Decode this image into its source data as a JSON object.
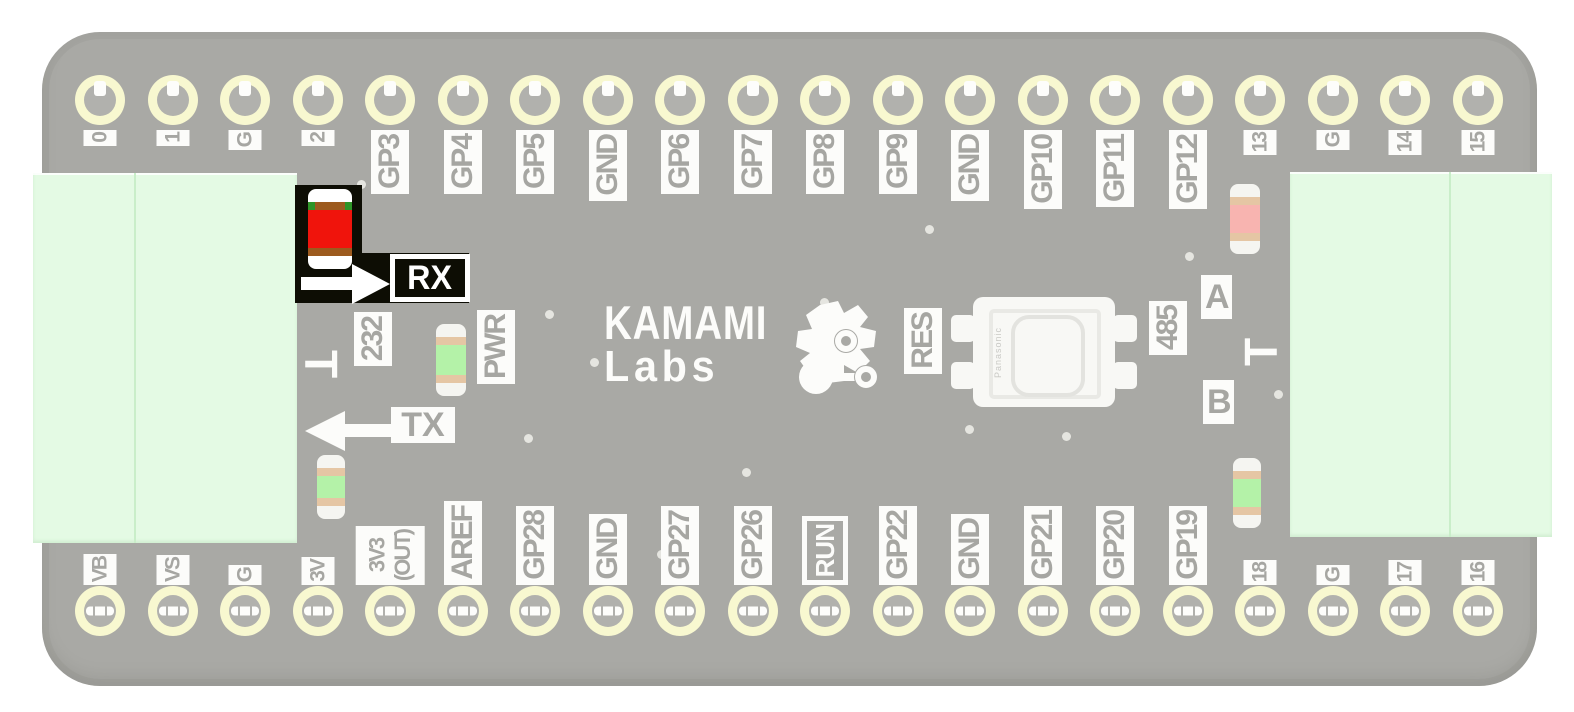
{
  "board": {
    "logo": {
      "line1": "KAMAMI",
      "line2": "Labs"
    },
    "highlight": {
      "label": "RX"
    },
    "silkscreen": {
      "tx": "TX",
      "rs232": "232",
      "rs485": "485",
      "pwr": "PWR",
      "res": "RES",
      "a": "A",
      "b": "B",
      "t_left": "T",
      "t_right": "T"
    },
    "button": {
      "brand": "Panasonic"
    },
    "top_pins": [
      {
        "label": "0",
        "type": "sm"
      },
      {
        "label": "1",
        "type": "sm"
      },
      {
        "label": "G",
        "type": "sm"
      },
      {
        "label": "2",
        "type": "sm"
      },
      {
        "label": "GP3",
        "type": "gp"
      },
      {
        "label": "GP4",
        "type": "gp"
      },
      {
        "label": "GP5",
        "type": "gp"
      },
      {
        "label": "GND",
        "type": "gp"
      },
      {
        "label": "GP6",
        "type": "gp"
      },
      {
        "label": "GP7",
        "type": "gp"
      },
      {
        "label": "GP8",
        "type": "gp"
      },
      {
        "label": "GP9",
        "type": "gp"
      },
      {
        "label": "GND",
        "type": "gp"
      },
      {
        "label": "GP10",
        "type": "gp"
      },
      {
        "label": "GP11",
        "type": "gp"
      },
      {
        "label": "GP12",
        "type": "gp"
      },
      {
        "label": "13",
        "type": "sm"
      },
      {
        "label": "G",
        "type": "sm"
      },
      {
        "label": "14",
        "type": "sm"
      },
      {
        "label": "15",
        "type": "sm"
      }
    ],
    "bottom_pins": [
      {
        "label": "VB",
        "type": "sm"
      },
      {
        "label": "VS",
        "type": "sm"
      },
      {
        "label": "G",
        "type": "sm"
      },
      {
        "label": "3V",
        "type": "sm"
      },
      {
        "label": "3V3\n(OUT)",
        "type": "wide"
      },
      {
        "label": "AREF",
        "type": "gp"
      },
      {
        "label": "GP28",
        "type": "gp"
      },
      {
        "label": "GND",
        "type": "gp"
      },
      {
        "label": "GP27",
        "type": "gp"
      },
      {
        "label": "GP26",
        "type": "gp"
      },
      {
        "label": "RUN",
        "type": "boxed"
      },
      {
        "label": "GP22",
        "type": "gp"
      },
      {
        "label": "GND",
        "type": "gp"
      },
      {
        "label": "GP21",
        "type": "gp"
      },
      {
        "label": "GP20",
        "type": "gp"
      },
      {
        "label": "GP19",
        "type": "gp"
      },
      {
        "label": "18",
        "type": "sm"
      },
      {
        "label": "G",
        "type": "sm"
      },
      {
        "label": "17",
        "type": "sm"
      },
      {
        "label": "16",
        "type": "sm"
      }
    ],
    "leds": [
      {
        "name": "rx-led",
        "color_key": "rx_red",
        "highlighted": true
      },
      {
        "name": "pwr-led",
        "color_key": "led_green",
        "highlighted": false
      },
      {
        "name": "gp13-led",
        "color_key": "led_pink",
        "highlighted": false
      },
      {
        "name": "v3-led",
        "color_key": "led_green",
        "highlighted": false
      },
      {
        "name": "pin18-led",
        "color_key": "led_green",
        "highlighted": false
      }
    ],
    "colors": {
      "board": "#a9a9a5",
      "silk_bg": "#fcfcfa",
      "silk_text": "#a6a6a2",
      "connector": "#e4fae4",
      "connector_line": "#c9eec9",
      "highlight_bg": "#0d0d04",
      "rx_red": "#f0140c",
      "led_green": "#b4f2a8",
      "led_pink": "#f8b4b0",
      "ring": "#f8f8d0",
      "hole_inner": "#b1b1ad"
    }
  }
}
